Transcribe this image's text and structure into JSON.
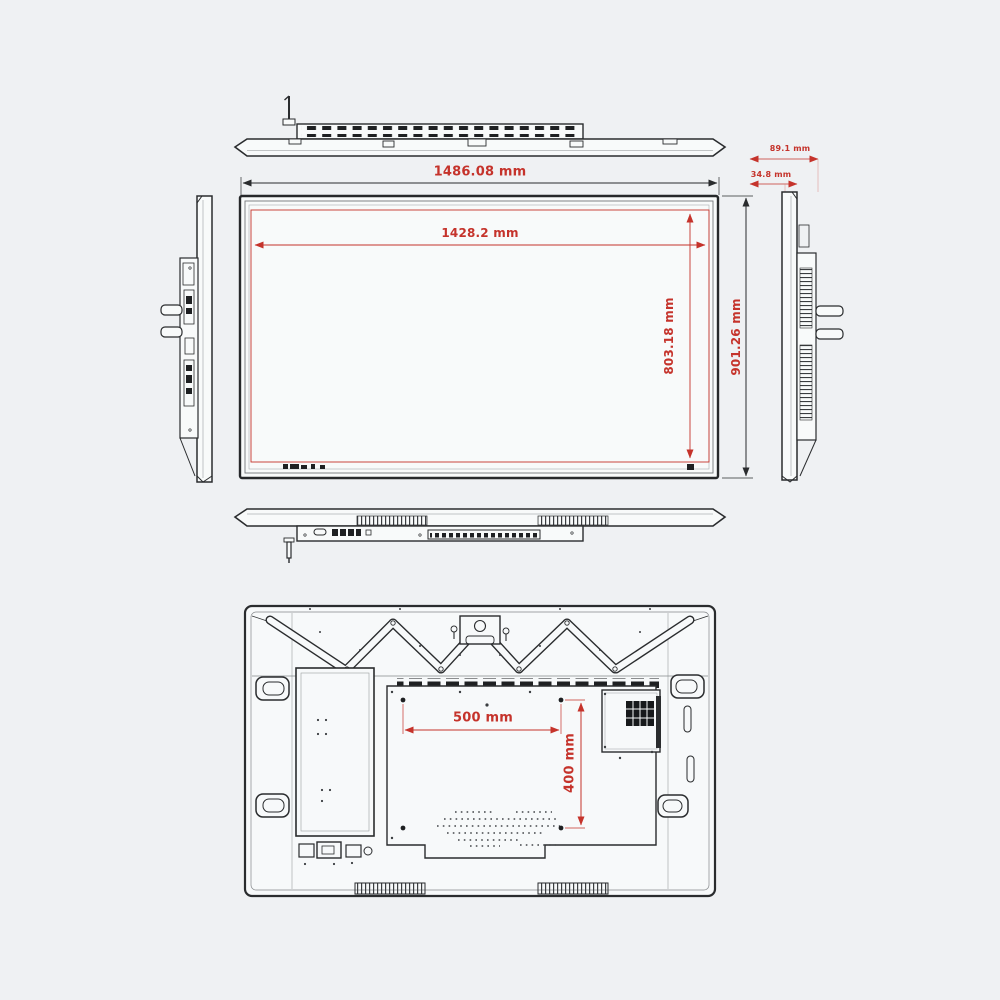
{
  "drawing": {
    "title": "display-dimension-drawing",
    "colors": {
      "background": "#eff1f3",
      "line": "#2a2c2e",
      "dimension_red": "#c5332b"
    }
  },
  "dimensions": {
    "overall_width": "1486.08 mm",
    "display_width": "1428.2 mm",
    "display_height": "803.18 mm",
    "overall_height": "901.26 mm",
    "depth": "89.1 mm",
    "top_depth": "34.8 mm",
    "vesa_width": "500 mm",
    "vesa_height": "400 mm"
  }
}
